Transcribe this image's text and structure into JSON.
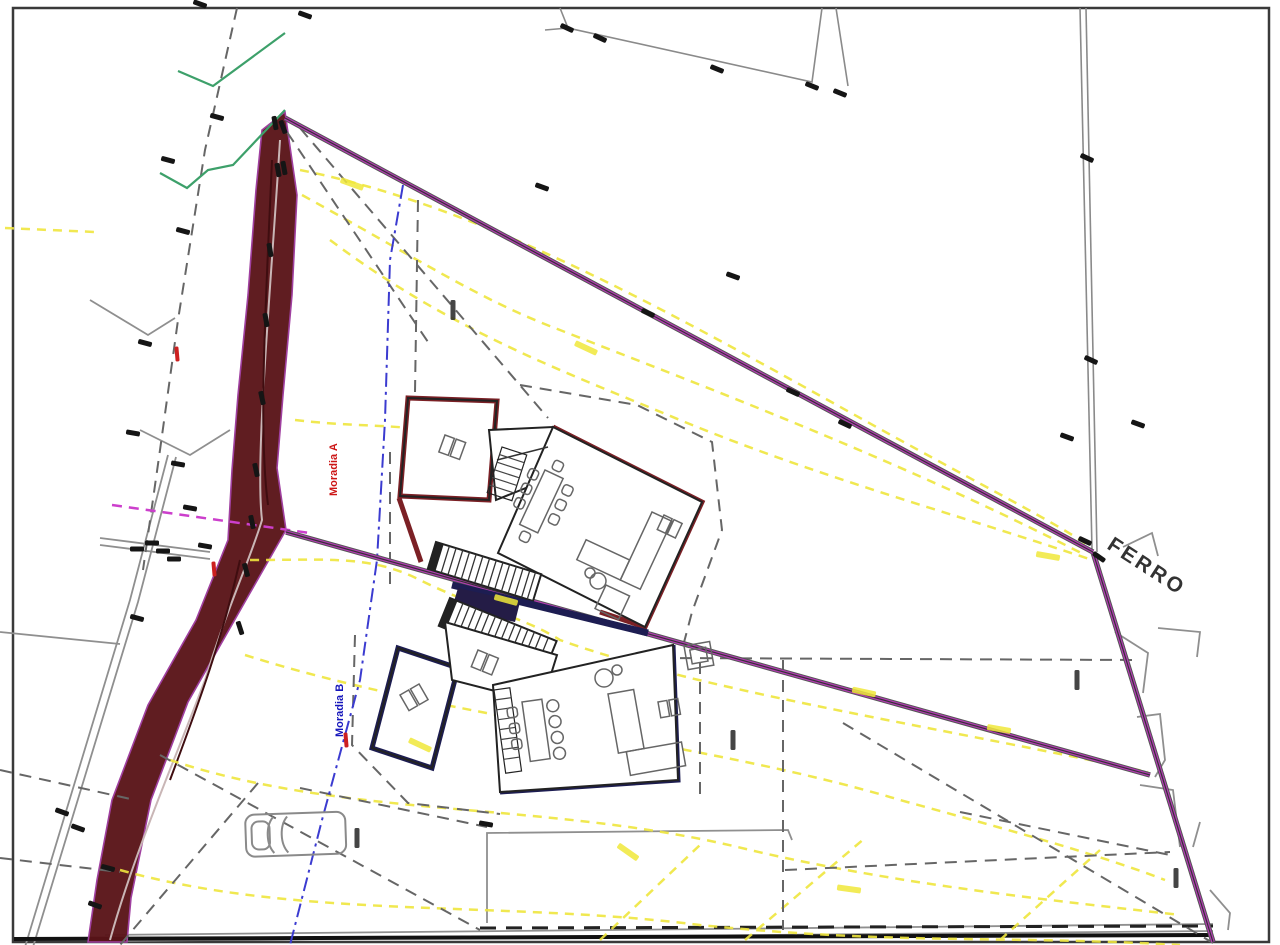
{
  "drawing": {
    "type": "architectural-site-plan",
    "labels": {
      "road": "FERRO",
      "house_a": "Moradia A",
      "house_b": "Moradia B"
    },
    "colors": {
      "embankment": "#5a1418",
      "boundary_purple": "#b53ab5",
      "contour_yellow": "#efe63e",
      "house_a_outline": "#7b2025",
      "house_b_outline": "#1d1d52",
      "axis_blue": "#3b3bd0",
      "greenery": "#3da06a",
      "magenta_dashed": "#cc3fcc",
      "marker_black": "#151515",
      "marker_red": "#cc2020"
    },
    "markers": {
      "black": [
        [
          567,
          28,
          25
        ],
        [
          600,
          38,
          25
        ],
        [
          717,
          69,
          22
        ],
        [
          812,
          86,
          22
        ],
        [
          840,
          93,
          22
        ],
        [
          542,
          187,
          20
        ],
        [
          283,
          127,
          70
        ],
        [
          284,
          168,
          80
        ],
        [
          648,
          313,
          25
        ],
        [
          733,
          276,
          20
        ],
        [
          793,
          392,
          25
        ],
        [
          845,
          424,
          25
        ],
        [
          1067,
          437,
          20
        ],
        [
          1087,
          158,
          25
        ],
        [
          1091,
          360,
          25
        ],
        [
          1085,
          541,
          25
        ],
        [
          1099,
          557,
          35
        ],
        [
          1138,
          424,
          20
        ],
        [
          200,
          4,
          20
        ],
        [
          305,
          15,
          20
        ],
        [
          217,
          117,
          15
        ],
        [
          168,
          160,
          15
        ],
        [
          183,
          231,
          15
        ],
        [
          145,
          343,
          15
        ],
        [
          133,
          433,
          10
        ],
        [
          178,
          464,
          10
        ],
        [
          190,
          508,
          10
        ],
        [
          152,
          543,
          0
        ],
        [
          163,
          551,
          0
        ],
        [
          174,
          559,
          0
        ],
        [
          205,
          546,
          10
        ],
        [
          137,
          549,
          0
        ],
        [
          275,
          123,
          80
        ],
        [
          278,
          170,
          80
        ],
        [
          270,
          250,
          80
        ],
        [
          266,
          320,
          80
        ],
        [
          262,
          398,
          78
        ],
        [
          256,
          470,
          78
        ],
        [
          252,
          522,
          78
        ],
        [
          246,
          570,
          75
        ],
        [
          240,
          628,
          72
        ],
        [
          62,
          812,
          20
        ],
        [
          78,
          828,
          20
        ],
        [
          108,
          868,
          15
        ],
        [
          137,
          618,
          15
        ],
        [
          95,
          905,
          20
        ],
        [
          486,
          824,
          10
        ]
      ],
      "red": [
        [
          177,
          354
        ],
        [
          214,
          569
        ],
        [
          346,
          740
        ]
      ],
      "elevation_labels": [
        [
          453,
          310
        ],
        [
          733,
          740
        ],
        [
          1077,
          680
        ],
        [
          1176,
          878
        ],
        [
          357,
          838
        ]
      ],
      "yellow_highlights": [
        [
          352,
          184,
          20
        ],
        [
          586,
          348,
          25
        ],
        [
          506,
          600,
          15
        ],
        [
          864,
          692,
          12
        ],
        [
          999,
          729,
          10
        ],
        [
          849,
          889,
          8
        ],
        [
          628,
          852,
          35
        ],
        [
          1048,
          556,
          10
        ],
        [
          420,
          745,
          25
        ]
      ]
    }
  }
}
